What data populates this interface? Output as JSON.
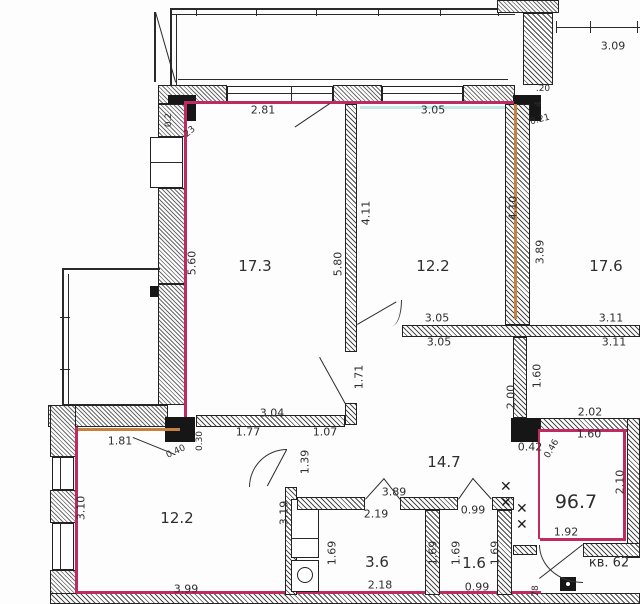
{
  "title": "apartment floor plan",
  "apartment": {
    "number_label": "кв. 62",
    "total_area": "96.7"
  },
  "colors": {
    "outline": "#bf2a60",
    "tan": "#c4813f",
    "cyan": "#c5e9e6",
    "wall_ink": "#2a2a2a"
  },
  "rooms": [
    {
      "area": "17.3"
    },
    {
      "area": "12.2"
    },
    {
      "area": "17.6"
    },
    {
      "area": "14.7"
    },
    {
      "area": "12.2"
    },
    {
      "area": "3.6"
    },
    {
      "area": "1.6"
    }
  ],
  "labels": [
    {
      "t": "17.3",
      "x": 255,
      "y": 266,
      "c": "room",
      "n": "room-area-17-3"
    },
    {
      "t": "12.2",
      "x": 433,
      "y": 266,
      "c": "room",
      "n": "room-area-12-2-top"
    },
    {
      "t": "17.6",
      "x": 606,
      "y": 266,
      "c": "room",
      "n": "room-area-17-6"
    },
    {
      "t": "14.7",
      "x": 444,
      "y": 462,
      "c": "room",
      "n": "room-area-14-7"
    },
    {
      "t": "12.2",
      "x": 177,
      "y": 518,
      "c": "room",
      "n": "room-area-12-2-bottom"
    },
    {
      "t": "3.6",
      "x": 377,
      "y": 562,
      "c": "room",
      "n": "room-area-3-6"
    },
    {
      "t": "1.6",
      "x": 474,
      "y": 563,
      "c": "room",
      "n": "room-area-1-6"
    },
    {
      "t": "96.7",
      "x": 576,
      "y": 502,
      "c": "apt",
      "n": "total-area-96-7"
    },
    {
      "t": "кв. 62",
      "x": 609,
      "y": 563,
      "c": "aptnum",
      "n": "apartment-number"
    },
    {
      "t": "2.81",
      "x": 263,
      "y": 110,
      "c": "dim",
      "n": "dim-2-81"
    },
    {
      "t": "3.05",
      "x": 433,
      "y": 110,
      "c": "dim",
      "n": "dim-3-05-top"
    },
    {
      "t": "3.09",
      "x": 613,
      "y": 46,
      "c": "dim",
      "n": "dim-3-09"
    },
    {
      "t": "3.05",
      "x": 437,
      "y": 318,
      "c": "dim",
      "n": "dim-3-05-mid-a"
    },
    {
      "t": "3.05",
      "x": 439,
      "y": 342,
      "c": "dim",
      "n": "dim-3-05-mid-b"
    },
    {
      "t": "3.11",
      "x": 611,
      "y": 318,
      "c": "dim",
      "n": "dim-3-11-a"
    },
    {
      "t": "3.11",
      "x": 614,
      "y": 342,
      "c": "dim",
      "n": "dim-3-11-b"
    },
    {
      "t": "2.02",
      "x": 590,
      "y": 412,
      "c": "dim",
      "n": "dim-2-02"
    },
    {
      "t": "1.60",
      "x": 589,
      "y": 434,
      "c": "dim",
      "n": "dim-1-60-h"
    },
    {
      "t": "0.42",
      "x": 530,
      "y": 447,
      "c": "dim",
      "n": "dim-0-42"
    },
    {
      "t": "1.92",
      "x": 566,
      "y": 532,
      "c": "dim",
      "n": "dim-1-92"
    },
    {
      "t": "3.04",
      "x": 272,
      "y": 413,
      "c": "dim",
      "n": "dim-3-04"
    },
    {
      "t": "1.77",
      "x": 248,
      "y": 432,
      "c": "dim",
      "n": "dim-1-77"
    },
    {
      "t": "1.07",
      "x": 325,
      "y": 432,
      "c": "dim",
      "n": "dim-1-07"
    },
    {
      "t": "1.81",
      "x": 120,
      "y": 441,
      "c": "dim",
      "n": "dim-1-81"
    },
    {
      "t": "3.99",
      "x": 186,
      "y": 589,
      "c": "dim",
      "n": "dim-3-99"
    },
    {
      "t": "3.89",
      "x": 394,
      "y": 492,
      "c": "dim",
      "n": "dim-3-89-h"
    },
    {
      "t": "2.19",
      "x": 376,
      "y": 514,
      "c": "dim",
      "n": "dim-2-19"
    },
    {
      "t": "0.99",
      "x": 473,
      "y": 510,
      "c": "dim",
      "n": "dim-0-99-a"
    },
    {
      "t": "2.18",
      "x": 380,
      "y": 585,
      "c": "dim",
      "n": "dim-2-18"
    },
    {
      "t": "0.99",
      "x": 477,
      "y": 587,
      "c": "dim",
      "n": "dim-0-99-b"
    },
    {
      "t": "5.60",
      "x": 192,
      "y": 263,
      "c": "dim",
      "r": -90,
      "n": "dim-5-60"
    },
    {
      "t": "5.80",
      "x": 338,
      "y": 264,
      "c": "dim",
      "r": -90,
      "n": "dim-5-80"
    },
    {
      "t": "4.11",
      "x": 366,
      "y": 213,
      "c": "dim",
      "r": -90,
      "n": "dim-4-11"
    },
    {
      "t": "4.10",
      "x": 513,
      "y": 208,
      "c": "dim",
      "r": -90,
      "n": "dim-4-10"
    },
    {
      "t": "3.89",
      "x": 540,
      "y": 252,
      "c": "dim",
      "r": -90,
      "n": "dim-3-89-v"
    },
    {
      "t": "1.71",
      "x": 359,
      "y": 377,
      "c": "dim",
      "r": -90,
      "n": "dim-1-71"
    },
    {
      "t": "2.00",
      "x": 511,
      "y": 397,
      "c": "dim",
      "r": -90,
      "n": "dim-2-00"
    },
    {
      "t": "1.60",
      "x": 537,
      "y": 376,
      "c": "dim",
      "r": -90,
      "n": "dim-1-60-v"
    },
    {
      "t": "2.10",
      "x": 620,
      "y": 482,
      "c": "dim",
      "r": -90,
      "n": "dim-2-10"
    },
    {
      "t": "1.39",
      "x": 305,
      "y": 462,
      "c": "dim",
      "r": -90,
      "n": "dim-1-39"
    },
    {
      "t": "3.19",
      "x": 284,
      "y": 513,
      "c": "dim",
      "r": -90,
      "n": "dim-3-19"
    },
    {
      "t": "3.10",
      "x": 81,
      "y": 508,
      "c": "dim",
      "r": -90,
      "n": "dim-3-10"
    },
    {
      "t": "1.69",
      "x": 332,
      "y": 553,
      "c": "dim",
      "r": -90,
      "n": "dim-1-69-a"
    },
    {
      "t": "1.69",
      "x": 433,
      "y": 553,
      "c": "dim",
      "r": -90,
      "n": "dim-1-69-b"
    },
    {
      "t": "1.69",
      "x": 456,
      "y": 553,
      "c": "dim",
      "r": -90,
      "n": "dim-1-69-c"
    },
    {
      "t": "1.69",
      "x": 495,
      "y": 553,
      "c": "dim",
      "r": -90,
      "n": "dim-1-69-d"
    },
    {
      "t": "78",
      "x": 536,
      "y": 591,
      "c": "sm",
      "r": -90,
      "n": "dim-78"
    },
    {
      "t": ".20",
      "x": 543,
      "y": 89,
      "c": "sm",
      "n": "dim-0-20"
    },
    {
      "t": "0.21",
      "x": 540,
      "y": 120,
      "c": "sm",
      "r": -15,
      "n": "dim-0-21"
    },
    {
      "t": "4",
      "x": 539,
      "y": 104,
      "c": "sm",
      "r": -90,
      "n": "dim-0-4"
    },
    {
      "t": "0.2",
      "x": 169,
      "y": 120,
      "c": "sm",
      "r": -90,
      "n": "dim-0-2"
    },
    {
      "t": "23",
      "x": 190,
      "y": 132,
      "c": "sm",
      "r": -40,
      "n": "dim-0-23"
    },
    {
      "t": "0.40",
      "x": 176,
      "y": 452,
      "c": "sm",
      "r": -25,
      "n": "dim-0-40"
    },
    {
      "t": "0.30",
      "x": 200,
      "y": 441,
      "c": "sm",
      "r": -90,
      "n": "dim-0-30"
    },
    {
      "t": "0.46",
      "x": 552,
      "y": 449,
      "c": "sm",
      "r": -60,
      "n": "dim-0-46"
    }
  ]
}
